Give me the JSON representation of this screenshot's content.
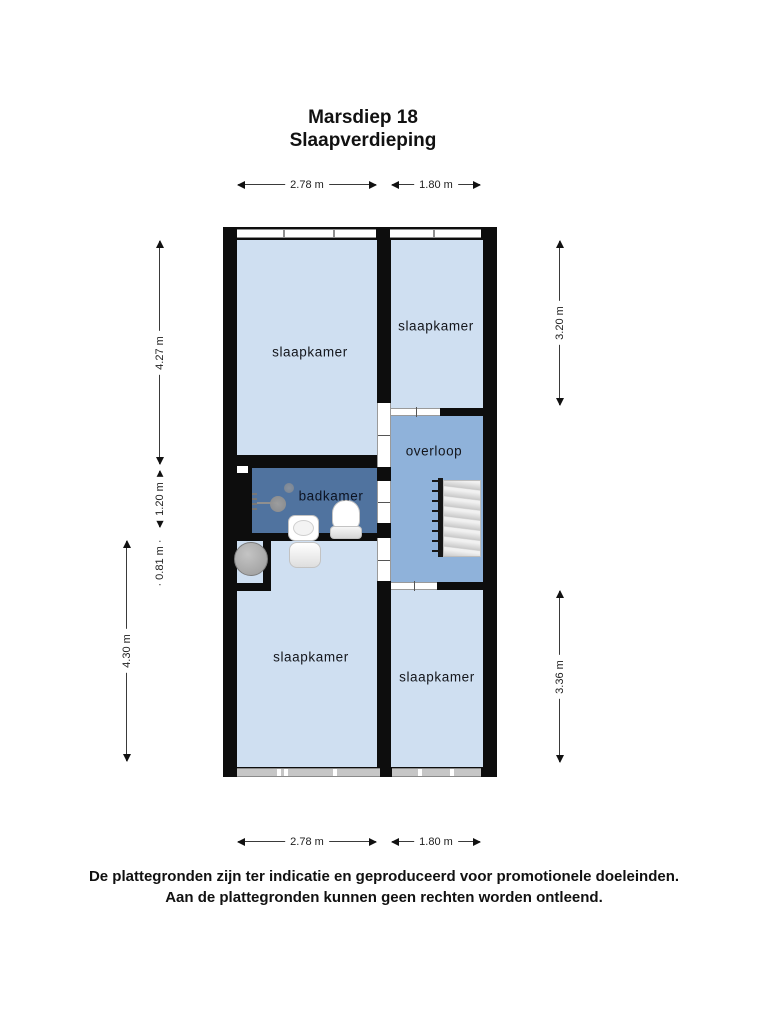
{
  "title": {
    "line1": "Marsdiep 18",
    "line2": "Slaapverdieping"
  },
  "rooms": {
    "top_left": {
      "label": "slaapkamer"
    },
    "top_right": {
      "label": "slaapkamer"
    },
    "overloop": {
      "label": "overloop"
    },
    "badkamer": {
      "label": "badkamer"
    },
    "bottom_left": {
      "label": "slaapkamer"
    },
    "bottom_right": {
      "label": "slaapkamer"
    }
  },
  "fixtures": {
    "stairs": "stairs",
    "toilet": "toilet",
    "sink": "sink",
    "shower": "shower",
    "boiler": "boiler"
  },
  "dimensions": {
    "top": [
      {
        "label": "2.78 m"
      },
      {
        "label": "1.80 m"
      }
    ],
    "bottom": [
      {
        "label": "2.78 m"
      },
      {
        "label": "1.80 m"
      }
    ],
    "left": [
      {
        "label": "4.27 m"
      },
      {
        "label": "1.20 m"
      },
      {
        "label": "0.81 m"
      },
      {
        "label": "4.30 m"
      }
    ],
    "right": [
      {
        "label": "3.20 m"
      },
      {
        "label": "3.36 m"
      }
    ]
  },
  "footer": {
    "line1": "De plattegronden zijn ter indicatie en geproduceerd voor promotionele doeleinden.",
    "line2": "Aan de plattegronden kunnen geen rechten worden ontleend."
  },
  "colors": {
    "wall": "#0d0d0d",
    "room": "#cfdff1",
    "overloop": "#8fb2da",
    "badkamer": "#50739f",
    "window_line": "#8f8f8f",
    "window_sill": "#c6c6c6",
    "stairs": "#dcdcdc",
    "fixture": "#ffffff",
    "boiler": "#a9a9a9",
    "dim_text": "#1d1d1d"
  }
}
